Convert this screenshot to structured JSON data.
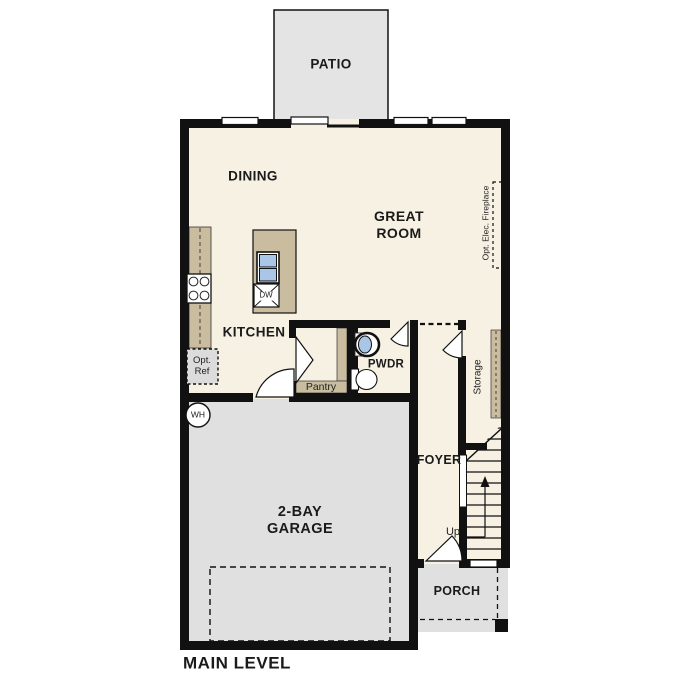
{
  "rooms": {
    "patio": "PATIO",
    "dining": "DINING",
    "great_room_line1": "GREAT",
    "great_room_line2": "ROOM",
    "kitchen": "KITCHEN",
    "pwdr": "PWDR",
    "pantry": "Pantry",
    "storage": "Storage",
    "foyer": "FOYER",
    "garage_line1": "2-BAY",
    "garage_line2": "GARAGE",
    "porch": "PORCH"
  },
  "fixtures": {
    "dishwasher": "DW",
    "water_heater": "WH",
    "opt_ref_line1": "Opt.",
    "opt_ref_line2": "Ref",
    "opt_fireplace": "Opt. Elec. Fireplace",
    "stairs_up": "Up"
  },
  "footer": {
    "plan_label": "MAIN LEVEL"
  },
  "colors": {
    "interior": "#f7f1e3",
    "garage": "#e0e0e0",
    "patio": "#e4e4e4",
    "porch": "#e0e0e0",
    "counter_tan": "#c9bc9f",
    "sink_blue": "#a9c6e6",
    "wall": "#111111",
    "background": "#ffffff"
  }
}
